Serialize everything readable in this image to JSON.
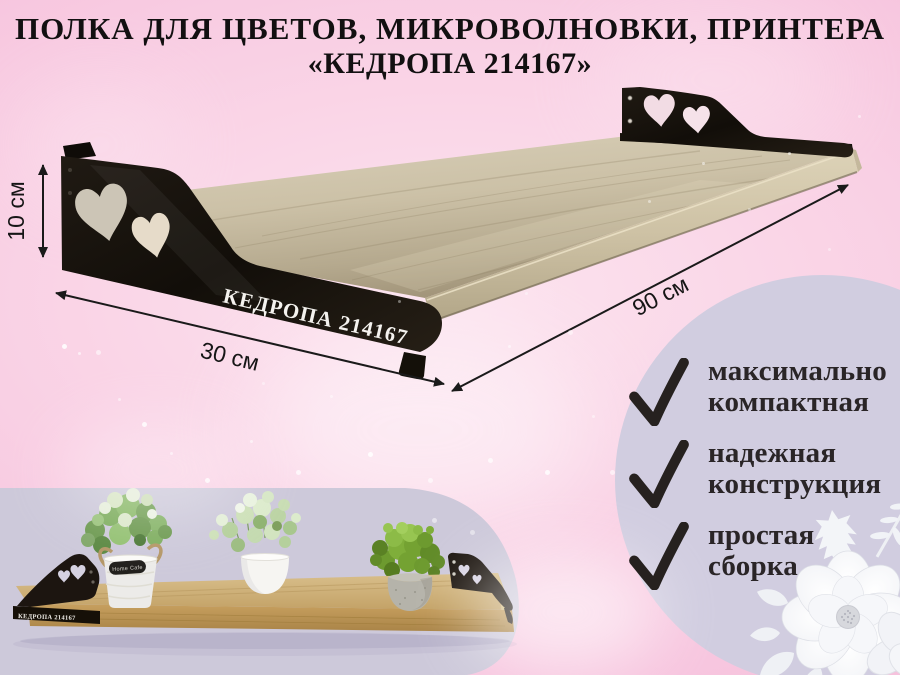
{
  "page": {
    "title_line1": "ПОЛКА ДЛЯ ЦВЕТОВ, МИКРОВОЛНОВКИ, ПРИНТЕРА",
    "title_line2": "«КЕДРОПА 214167»"
  },
  "product": {
    "brand_plate_text": "КЕДРОПА 214167",
    "dimensions": {
      "height_label": "10 см",
      "depth_label": "30 см",
      "length_label": "90 см"
    }
  },
  "features": [
    {
      "line1": "максимально",
      "line2": "компактная"
    },
    {
      "line1": "надежная",
      "line2": "конструкция"
    },
    {
      "line1": "простая",
      "line2": "сборка"
    }
  ],
  "inset_photo": {
    "bracket_text": "КЕДРОПА 214167",
    "pot_label_text": "Home Cafe"
  },
  "colors": {
    "background_pink": "#f5c4de",
    "accent_lavender": "#d1cde0",
    "bracket_black": "#1a140d",
    "wood_light": "#cfc4aa",
    "text_dark": "#141213"
  }
}
